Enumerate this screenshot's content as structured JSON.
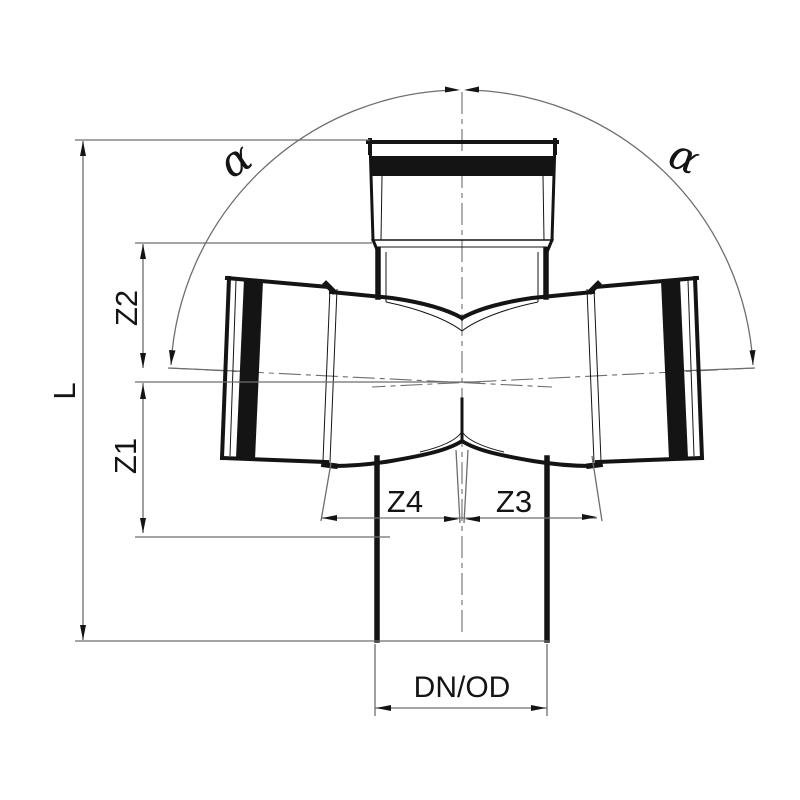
{
  "drawing": {
    "type": "pipe-fitting-dimensional-drawing",
    "subject": "double-branch cross fitting, sectional view with dimension lines",
    "labels": {
      "overall_length": "L",
      "z2": "Z2",
      "z1": "Z1",
      "z4": "Z4",
      "z3": "Z3",
      "diameter": "DN/OD",
      "angle_left": "α",
      "angle_right": "α"
    },
    "colors": {
      "outline": "#141414",
      "dimension_lines": "#6d6d6d",
      "background": "#ffffff"
    }
  }
}
